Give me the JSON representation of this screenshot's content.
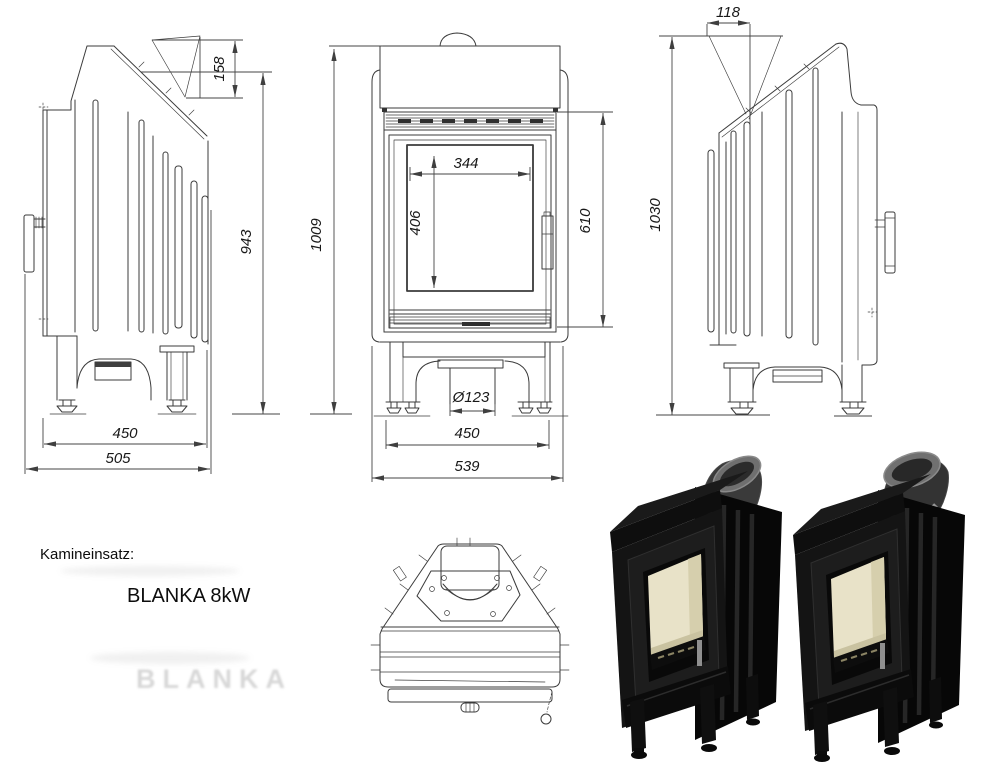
{
  "caption": {
    "label": "Kamineinsatz:",
    "model": "BLANKA 8kW",
    "watermark": "BLANKA"
  },
  "views": {
    "side_left": {
      "dims": {
        "flue_height": "158",
        "body_height": "943",
        "foot_span": "450",
        "depth": "505"
      }
    },
    "front": {
      "dims": {
        "total_height": "1009",
        "glass_width": "344",
        "glass_height": "406",
        "door_height": "610",
        "flue_diameter": "Ø123",
        "foot_span": "450",
        "width": "539"
      }
    },
    "side_right": {
      "dims": {
        "flue_offset": "118",
        "total_height": "1030"
      }
    }
  },
  "colors": {
    "drawing_line": "#3b3b3b",
    "photo_body": "#121212",
    "photo_interior": "#e8e2c8",
    "photo_pipe": "#6f6f6f",
    "background": "#ffffff"
  }
}
